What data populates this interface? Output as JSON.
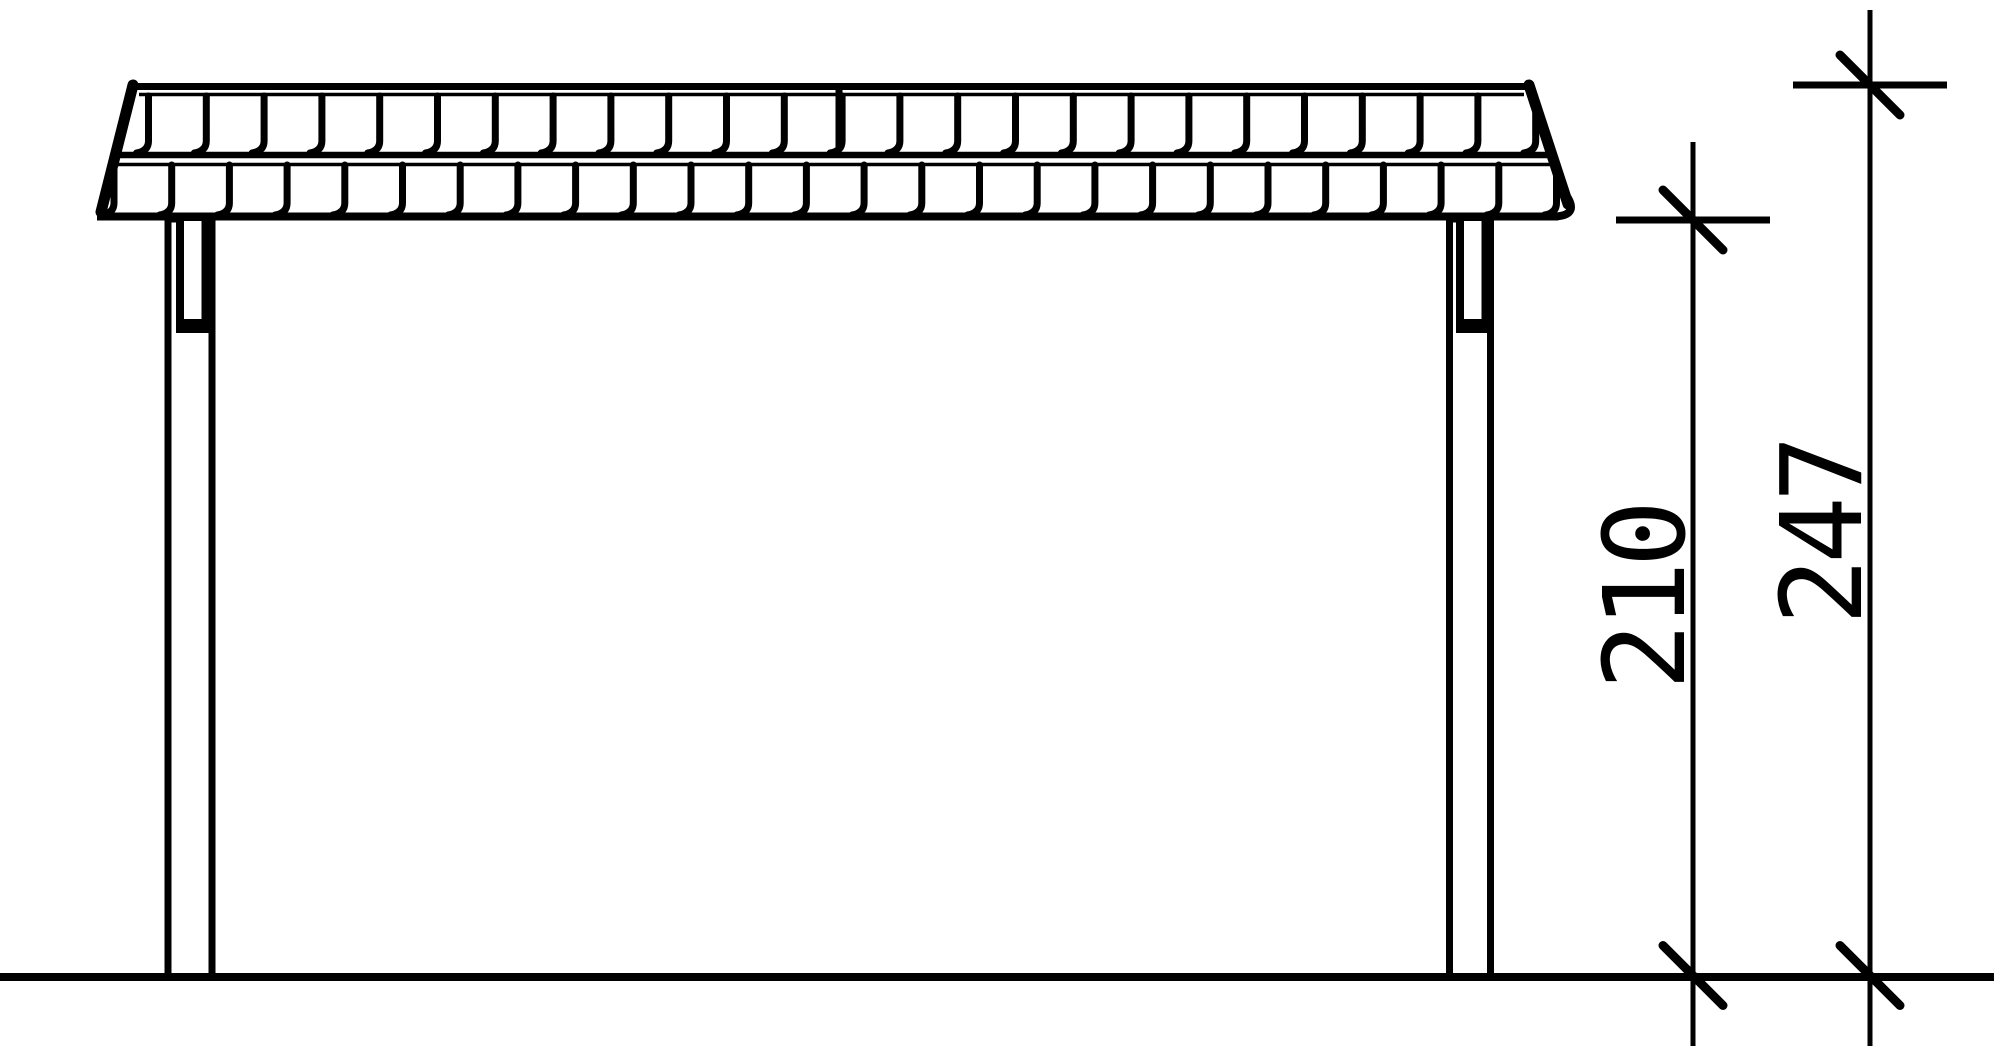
{
  "canvas": {
    "width": 1994,
    "height": 1058,
    "background": "#ffffff",
    "ink": "#000000"
  },
  "ground": {
    "x1": 0,
    "x2": 1994,
    "y": 977,
    "stroke": 8
  },
  "roof": {
    "clip_polygon": [
      [
        100,
        219
      ],
      [
        134,
        83
      ],
      [
        1531,
        83
      ],
      [
        1572,
        209
      ],
      [
        1556,
        219
      ]
    ],
    "ridge_top": {
      "x1": 131,
      "y": 86.5,
      "x2": 1532,
      "stroke": 7
    },
    "ridge_inner": {
      "x1": 139,
      "y": 94.5,
      "x2": 1524,
      "stroke": 3.5
    },
    "mid_line": {
      "x1": 112,
      "y": 155,
      "x2": 1553,
      "stroke": 6.5
    },
    "row2_top": {
      "x1": 109,
      "y": 164.5,
      "x2": 1551,
      "stroke": 3.5
    },
    "eaves": {
      "x1": 97,
      "y": 216.5,
      "x2": 1558,
      "stroke": 8
    },
    "left_edge": {
      "x1": 133,
      "y1": 85,
      "x2": 101,
      "y2": 212,
      "stroke": 11
    },
    "right_edge": {
      "x1": 1529,
      "y1": 85,
      "x2": 1568,
      "y2": 204,
      "stroke": 11
    },
    "right_hook": {
      "d": "M 1568 198 Q 1579 217.5 1549 216.5",
      "stroke": 8
    },
    "ridge_joint": {
      "x": 839,
      "y1": 84,
      "y2": 148,
      "stroke": 7
    },
    "shingle_rows": [
      {
        "name": "row-1",
        "start_x": 148.5,
        "spacing": 57.8,
        "count": 25,
        "top_y": 96,
        "foot_y": 153,
        "foot_dx": -12,
        "stroke": 7
      },
      {
        "name": "row-2",
        "start_x": 114,
        "spacing": 57.7,
        "count": 26,
        "top_y": 165,
        "foot_y": 215,
        "foot_dx": -12,
        "stroke": 7
      }
    ]
  },
  "posts": [
    {
      "name": "post-left",
      "outer": {
        "x": 168,
        "y": 219,
        "width": 44,
        "height": 758,
        "stroke": 7
      },
      "bracket": {
        "x": 176,
        "y": 221,
        "width": 33,
        "height": 112
      },
      "slot": {
        "x": 184,
        "y": 221,
        "width": 17.5,
        "height": 98
      }
    },
    {
      "name": "post-right",
      "outer": {
        "x": 1449.5,
        "y": 219,
        "width": 41,
        "height": 758,
        "stroke": 7
      },
      "bracket": {
        "x": 1456,
        "y": 221,
        "width": 33,
        "height": 112
      },
      "slot": {
        "x": 1464,
        "y": 221,
        "width": 17.5,
        "height": 98
      }
    }
  ],
  "dimensions": [
    {
      "name": "height-to-eaves",
      "label": "210",
      "x": 1693,
      "line_top": 142,
      "line_bottom": 1046,
      "line_stroke": 5,
      "ticks": [
        {
          "y": 220,
          "horizontal": true
        },
        {
          "y": 975.5,
          "horizontal": false
        }
      ],
      "tick_half_len": 77,
      "tick_stroke": 7,
      "slash_half": 30,
      "slash_stroke": 9,
      "label_x": 1684,
      "label_y": 598
    },
    {
      "name": "overall-height",
      "label": "247",
      "x": 1870,
      "line_top": 10,
      "line_bottom": 1046,
      "line_stroke": 5,
      "ticks": [
        {
          "y": 85,
          "horizontal": true
        },
        {
          "y": 975.5,
          "horizontal": false
        }
      ],
      "tick_half_len": 77,
      "tick_stroke": 7,
      "slash_half": 30,
      "slash_stroke": 9,
      "label_x": 1861,
      "label_y": 533
    }
  ]
}
